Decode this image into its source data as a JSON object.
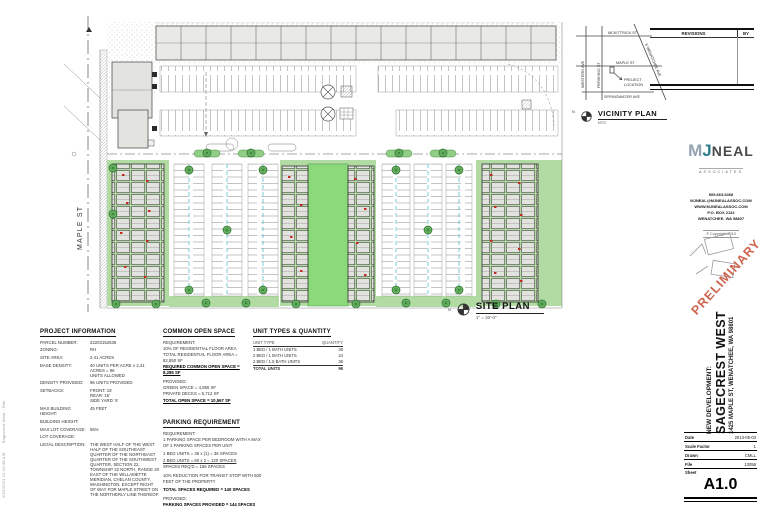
{
  "plot_stamp": {
    "datetime": "2/15/2021 11:10:48 AM",
    "file": "Sagecrest West - Site"
  },
  "site_plan": {
    "label": "SITE PLAN",
    "scale": "1\" = 30'-0\"",
    "street_label": "MAPLE ST",
    "north": "N"
  },
  "vicinity": {
    "title": "VICINITY PLAN",
    "scale": "NTS",
    "north": "N",
    "streets": {
      "top": "MCKITTRICK ST",
      "middle": "MAPLE ST",
      "bottom": "SPRINGWATER AVE",
      "left": "WESTERN AVE",
      "left2": "PERSHING ST",
      "diagonal": "S WENATCHEE AVE"
    },
    "marker_line1": "PROJECT",
    "marker_line2": "LOCATION"
  },
  "revisions": {
    "header": "REVISIONS",
    "by": "BY"
  },
  "firm": {
    "logo_m": "M",
    "logo_j": "J",
    "logo_neal": "NEAL",
    "logo_sub": "ASSOCIATES",
    "phone": "509.663.6468",
    "email": "MJNEAL@MJNEALASSOC.COM",
    "web": "WWW.MJNEALASSOC.COM",
    "po_box": "P.O. BOX 2132",
    "city": "WENATCHEE, WA 98807",
    "copyright": "© Copyright 2013"
  },
  "stamp": {
    "text": "PRELIMINARY"
  },
  "titleblock": {
    "project_type": "NEW DEVELOPMENT:",
    "project_name": "SAGECREST WEST",
    "address": "1425 MAPLE ST, WENATCHEE, WA 98801",
    "fields": [
      {
        "label": "Date",
        "value": "2013-05-03"
      },
      {
        "label": "Scale Factor",
        "value": "1"
      },
      {
        "label": "Drawn",
        "value": "CMLL"
      },
      {
        "label": "File",
        "value": "13056"
      }
    ],
    "sheet_label": "Sheet",
    "sheet_number": "A1.0"
  },
  "project_information": {
    "header": "PROJECT INFORMATION",
    "rows": [
      {
        "label": "PARCEL NUMBER:",
        "value": "22203152535"
      },
      {
        "label": "ZONING:",
        "value": "RH"
      },
      {
        "label": "SITE AREA:",
        "value": "2.41 ACRES"
      },
      {
        "label": "BASE DENSITY:",
        "value": "40 UNITS PER ACRE x 2.41 ACRES = 96\nUNITS ALLOWED"
      },
      {
        "label": "DENSITY PROVIDED:",
        "value": "96 UNITS PROVIDED"
      },
      {
        "label": "SETBACKS:",
        "value": "FRONT:  15'\nREAR:  15'\nSIDE YARD:  5'"
      },
      {
        "label": "MAX BUILDING\nHEIGHT:",
        "value": "45 FEET"
      },
      {
        "label": "BUILDING HEIGHT:",
        "value": ""
      },
      {
        "label": "MAX LOT COVERAGE:",
        "value": "55%"
      },
      {
        "label": "LOT COVERAGE:",
        "value": ""
      },
      {
        "label": "LEGAL DESCRIPTION:",
        "value": "THE WEST HALF OF THE WEST HALF OF THE SOUTHEAST QUARTER OF THE NORTHEAST QUARTER OF THE SOUTHWEST QUARTER, SECTION 22, TOWNSHIP 22 NORTH, RANGE 20 EAST OF THE WILLAMETTE MERIDIAN, CHELAN COUNTY, WASHINGTON, EXCEPT RIGHT OF WAY FOR MAPLE STREET ON THE NORTHERLY LINE THEREOF."
      }
    ]
  },
  "common_open_space": {
    "header": "COMMON OPEN SPACE",
    "lines": [
      "REQUIREMENT:",
      "10% OF RESIDENTIAL FLOOR AREA",
      "TOTAL RESIDENTIAL FLOOR AREA = 82,850 SF",
      "REQUIRED COMMON OPEN SPACE = 8,285 SF",
      "PROVIDED:",
      "GREEN SPACE = 4,855 SF",
      "PRIVATE DECKS = 5,712 SF",
      "TOTAL OPEN SPACE = 10,567 SF"
    ]
  },
  "parking": {
    "header": "PARKING REQUIREMENT",
    "lines": [
      "REQUIREMENT:",
      "1 PARKING SPACE PER BEDROOM WITH A MAX OF 2 PARKING SPACES PER UNIT",
      "1 BED UNITS = 36 x (1) = 36 SPACES",
      "2 BED UNITS = 60 x 2 = 120 SPACES",
      "SPACES REQ'D = 156 SPACES",
      "10% REDUCTION FOR TRANSIT STOP WITH 500 FEET OF THE PROPERTY",
      "TOTAL SPACES REQUIRED = 140 SPACES",
      "PROVIDED:",
      "PARKING SPACES PROVIDED = 144 SPACES"
    ]
  },
  "unit_table": {
    "header": "UNIT TYPES & QUANTITY",
    "col_type": "UNIT TYPE",
    "col_qty": "QUANTITY",
    "rows": [
      {
        "type": "1 BED / 1 BATH UNITS",
        "qty": "36"
      },
      {
        "type": "2 BED / 1 BATH UNITS",
        "qty": "24"
      },
      {
        "type": "2 BED / 1.5 BATH UNITS",
        "qty": "36"
      },
      {
        "type": "TOTAL UNITS",
        "qty": "96"
      }
    ]
  }
}
